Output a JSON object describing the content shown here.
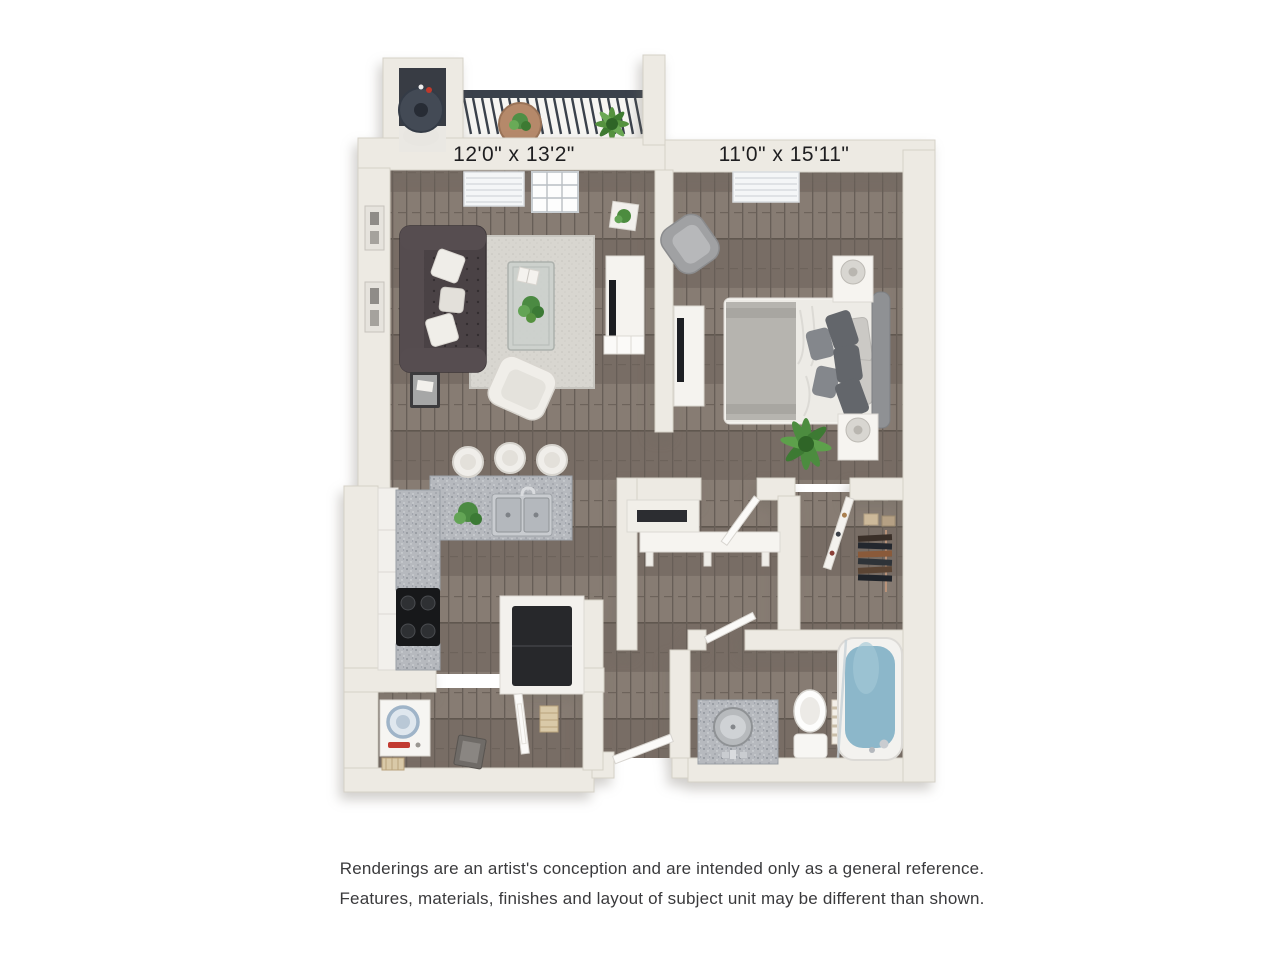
{
  "floorplan": {
    "living_room": {
      "dimensions": "12'0\" x 13'2\""
    },
    "bedroom": {
      "dimensions": "11'0\" x 15'11\""
    }
  },
  "disclaimer": {
    "line1": "Renderings are an artist's conception and are intended only as a general reference.",
    "line2": "Features, materials, finishes and layout of subject unit may be different than shown."
  },
  "colors": {
    "background": "#ffffff",
    "wall": "#edeae3",
    "wall_edge": "#d5d1c7",
    "floor_wood": "#7e746c",
    "rug": "#d8d6d0",
    "sofa": "#4a4245",
    "railing": "#3a414b",
    "granite": "#b6b9be",
    "tub_water": "#8cb7ca",
    "plant_green": "#4c8c3f",
    "label_text": "#1e1e20",
    "disclaimer_text": "#3a3a3c"
  }
}
